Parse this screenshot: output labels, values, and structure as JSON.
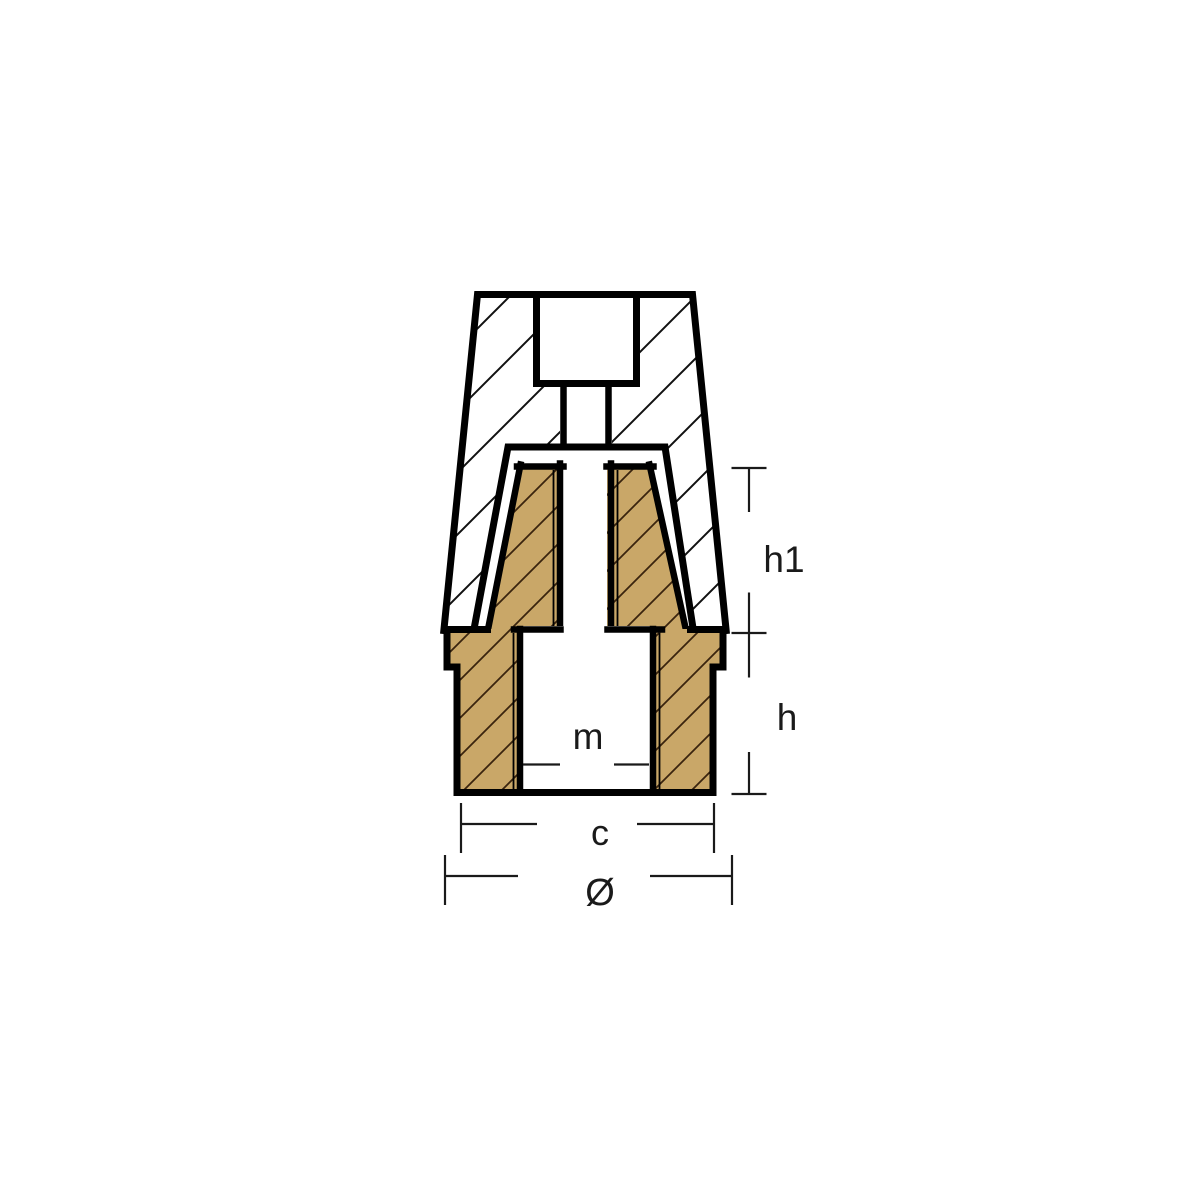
{
  "diagram": {
    "type": "technical-drawing-cross-section",
    "subject": "propeller-nut-anode",
    "labels": {
      "h1": "h1",
      "h": "h",
      "m": "m",
      "c": "c",
      "diameter": "Ø"
    },
    "colors": {
      "outline": "#000000",
      "bronze_fill": "#c9a768",
      "bronze_hatch_line": "#3a240e",
      "zinc_hatch_line": "#111111",
      "dimension_line": "#1a1a1a",
      "label_text": "#1a1a1a",
      "background": "#ffffff"
    }
  }
}
